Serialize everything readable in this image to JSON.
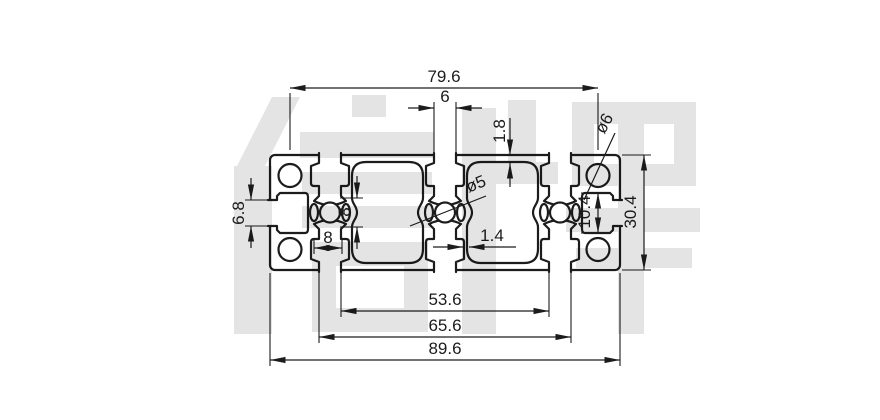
{
  "drawing": {
    "title": "aluminium-profile-cross-section",
    "watermark_text": "信牌",
    "colors": {
      "line": "#1c1c1c",
      "watermark": "#e4e4e4",
      "background": "#ffffff"
    },
    "dimensions": {
      "hole_spacing": "79.6",
      "slot_opening": "6",
      "top_wall": "1.8",
      "corner_hole": "ø6",
      "side_slot_opening": "6.8",
      "center_cavity": "8",
      "bottom_slot": "8",
      "center_hole": "ø5",
      "web_thickness": "1.4",
      "side_cavity": "10.4",
      "height": "30.4",
      "inner_span": "53.6",
      "mid_span": "65.6",
      "width": "89.6"
    }
  }
}
